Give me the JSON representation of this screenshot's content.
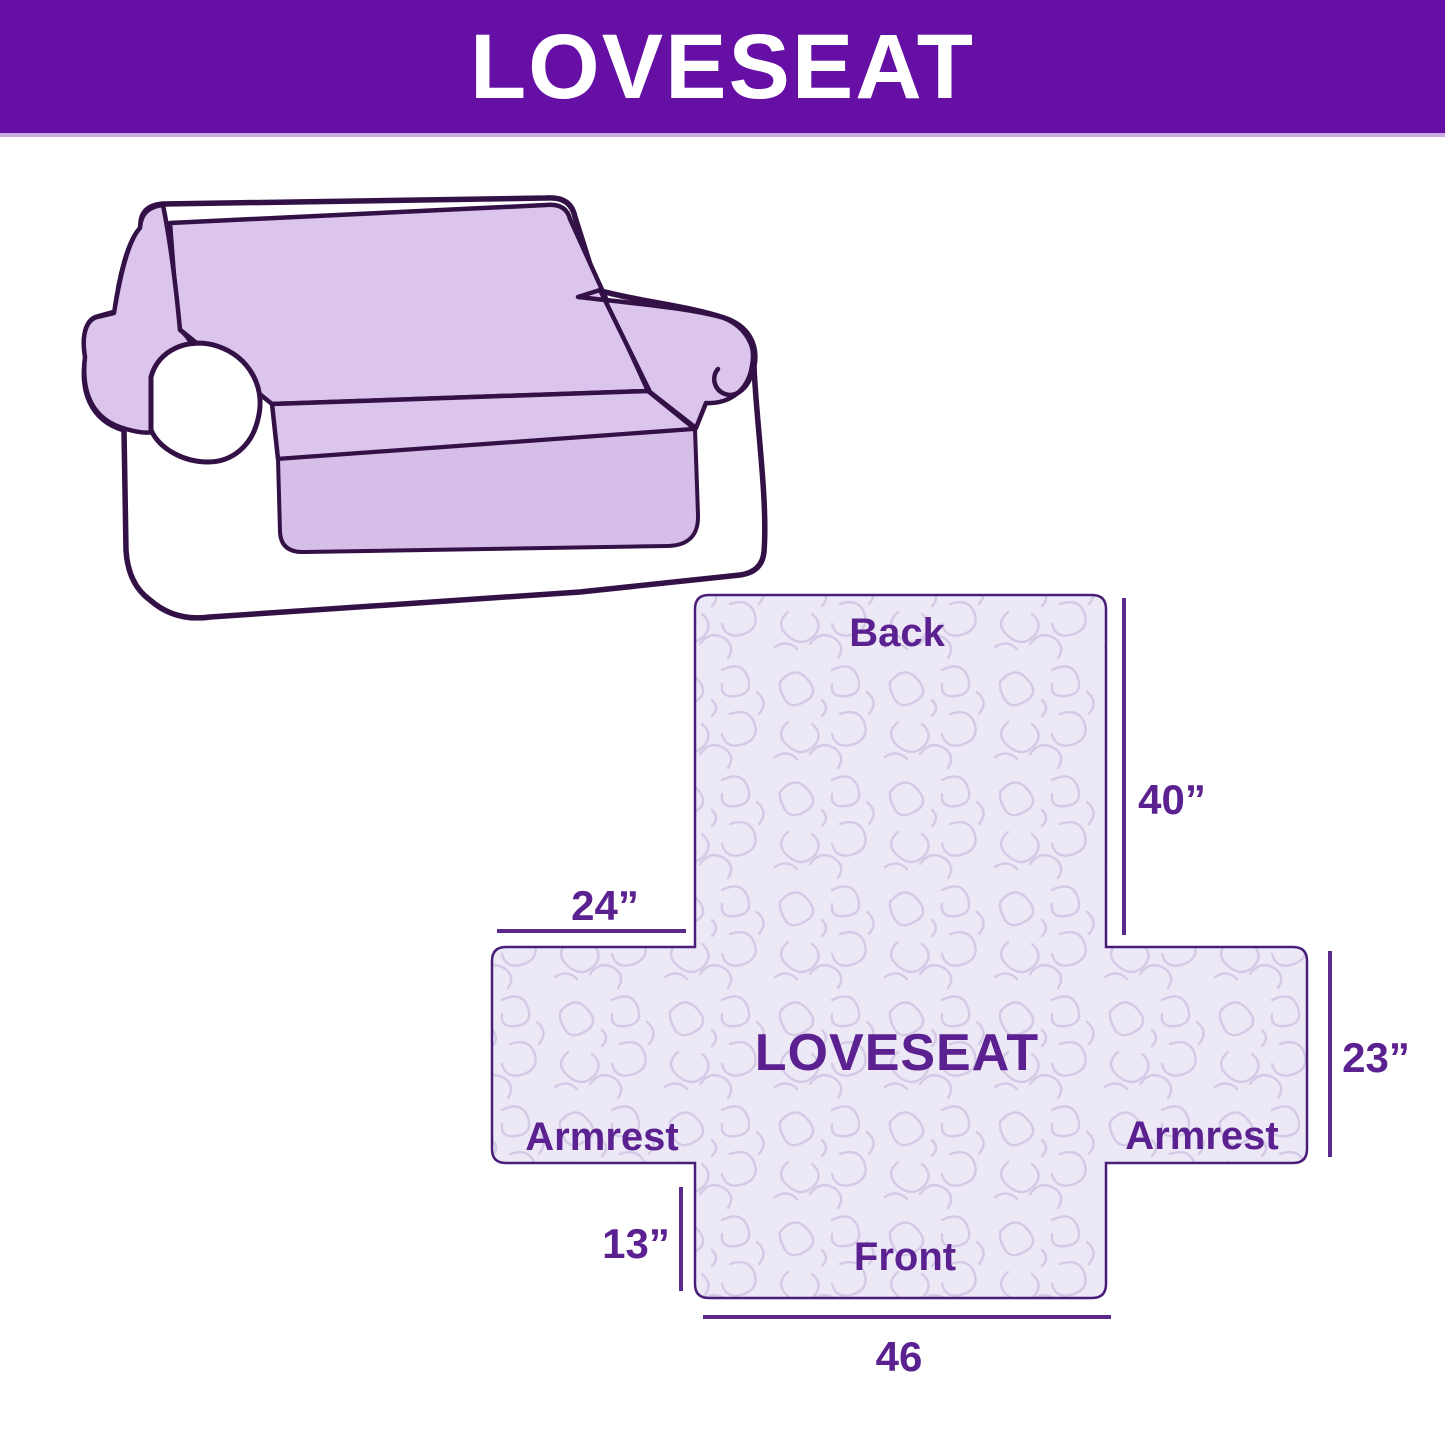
{
  "header": {
    "title": "LOVESEAT"
  },
  "illustration": {
    "description": "Loveseat sofa line drawing with lavender slipcover draped over back, seat and armrests"
  },
  "diagram": {
    "center_label": "LOVESEAT",
    "back_label": "Back",
    "front_label": "Front",
    "armrest_left_label": "Armrest",
    "armrest_right_label": "Armrest",
    "dim_back_height": "40”",
    "dim_armrest_top_width": "24”",
    "dim_armrest_height": "23”",
    "dim_front_skirt_height": "13”",
    "dim_front_width": "46"
  },
  "colors": {
    "banner_bg": "#650FA4",
    "banner_text": "#FFFFFF",
    "label_text": "#5B2190",
    "dimension_line": "#5B2A8C",
    "cover_fill": "#DBC5ED",
    "pattern_bg": "#EDE8F6",
    "pattern_squiggle": "#D3CAE6",
    "outline_dark": "#331147",
    "cross_border": "#4A1E78"
  }
}
